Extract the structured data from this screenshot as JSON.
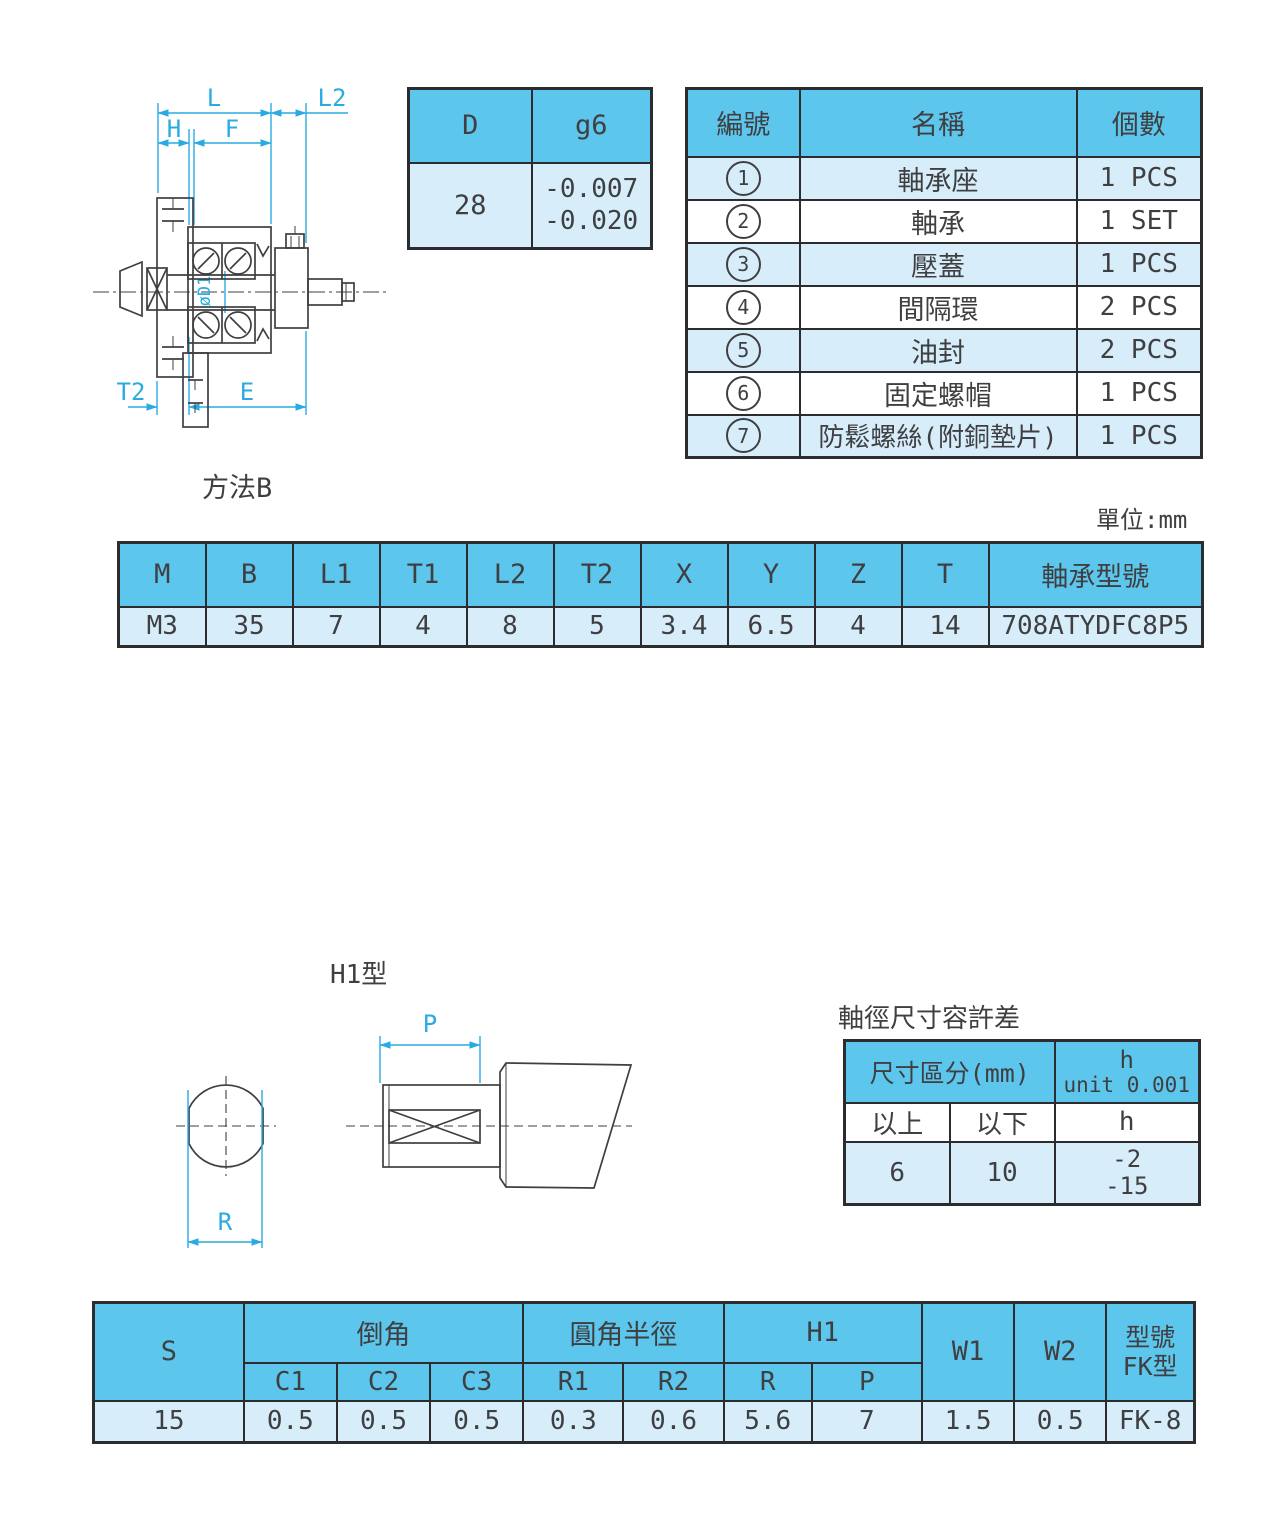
{
  "colors": {
    "header_blue": "#5cc6ec",
    "light_blue": "#d7eefa",
    "cyan": "#29abe2",
    "line_dark": "#3f3f42"
  },
  "labels": {
    "method": "方法B",
    "unit": "單位:mm",
    "h1_type": "H1型",
    "tolerance_title": "軸徑尺寸容許差"
  },
  "drawing1": {
    "labels": {
      "L": "L",
      "L2": "L2",
      "H": "H",
      "F": "F",
      "T2": "T2",
      "E": "E",
      "dia": "øD1"
    }
  },
  "drawing2": {
    "labels": {
      "P": "P",
      "R": "R"
    }
  },
  "fit_table": {
    "col_d": "D",
    "col_g6": "g6",
    "d_value": "28",
    "g6_upper": "-0.007",
    "g6_lower": "-0.020"
  },
  "parts_table": {
    "headers": {
      "no": "編號",
      "name": "名稱",
      "qty": "個數"
    },
    "rows": [
      {
        "no": "1",
        "name": "軸承座",
        "qty": "1 PCS"
      },
      {
        "no": "2",
        "name": "軸承",
        "qty": "1 SET"
      },
      {
        "no": "3",
        "name": "壓蓋",
        "qty": "1 PCS"
      },
      {
        "no": "4",
        "name": "間隔環",
        "qty": "2 PCS"
      },
      {
        "no": "5",
        "name": "油封",
        "qty": "2 PCS"
      },
      {
        "no": "6",
        "name": "固定螺帽",
        "qty": "1 PCS"
      },
      {
        "no": "7",
        "name": "防鬆螺絲(附銅墊片)",
        "qty": "1 PCS"
      }
    ]
  },
  "dim_table": {
    "headers": [
      "M",
      "B",
      "L1",
      "T1",
      "L2",
      "T2",
      "X",
      "Y",
      "Z",
      "T",
      "軸承型號"
    ],
    "values": [
      "M3",
      "35",
      "7",
      "4",
      "8",
      "5",
      "3.4",
      "6.5",
      "4",
      "14",
      "708ATYDFC8P5"
    ]
  },
  "tolerance_table": {
    "header_range": "尺寸區分(mm)",
    "header_h_line1": "h",
    "header_h_line2": "unit 0.001",
    "col_over": "以上",
    "col_under": "以下",
    "col_h": "h",
    "row": {
      "over": "6",
      "under": "10",
      "h_upper": "-2",
      "h_lower": "-15"
    }
  },
  "bottom_table": {
    "col_s": "S",
    "group_chamfer": "倒角",
    "group_fillet": "圓角半徑",
    "group_h1": "H1",
    "sub": [
      "C1",
      "C2",
      "C3",
      "R1",
      "R2",
      "R",
      "P"
    ],
    "col_w1": "W1",
    "col_w2": "W2",
    "col_model_line1": "型號",
    "col_model_line2": "FK型",
    "values": [
      "15",
      "0.5",
      "0.5",
      "0.5",
      "0.3",
      "0.6",
      "5.6",
      "7",
      "1.5",
      "0.5",
      "FK-8"
    ]
  }
}
